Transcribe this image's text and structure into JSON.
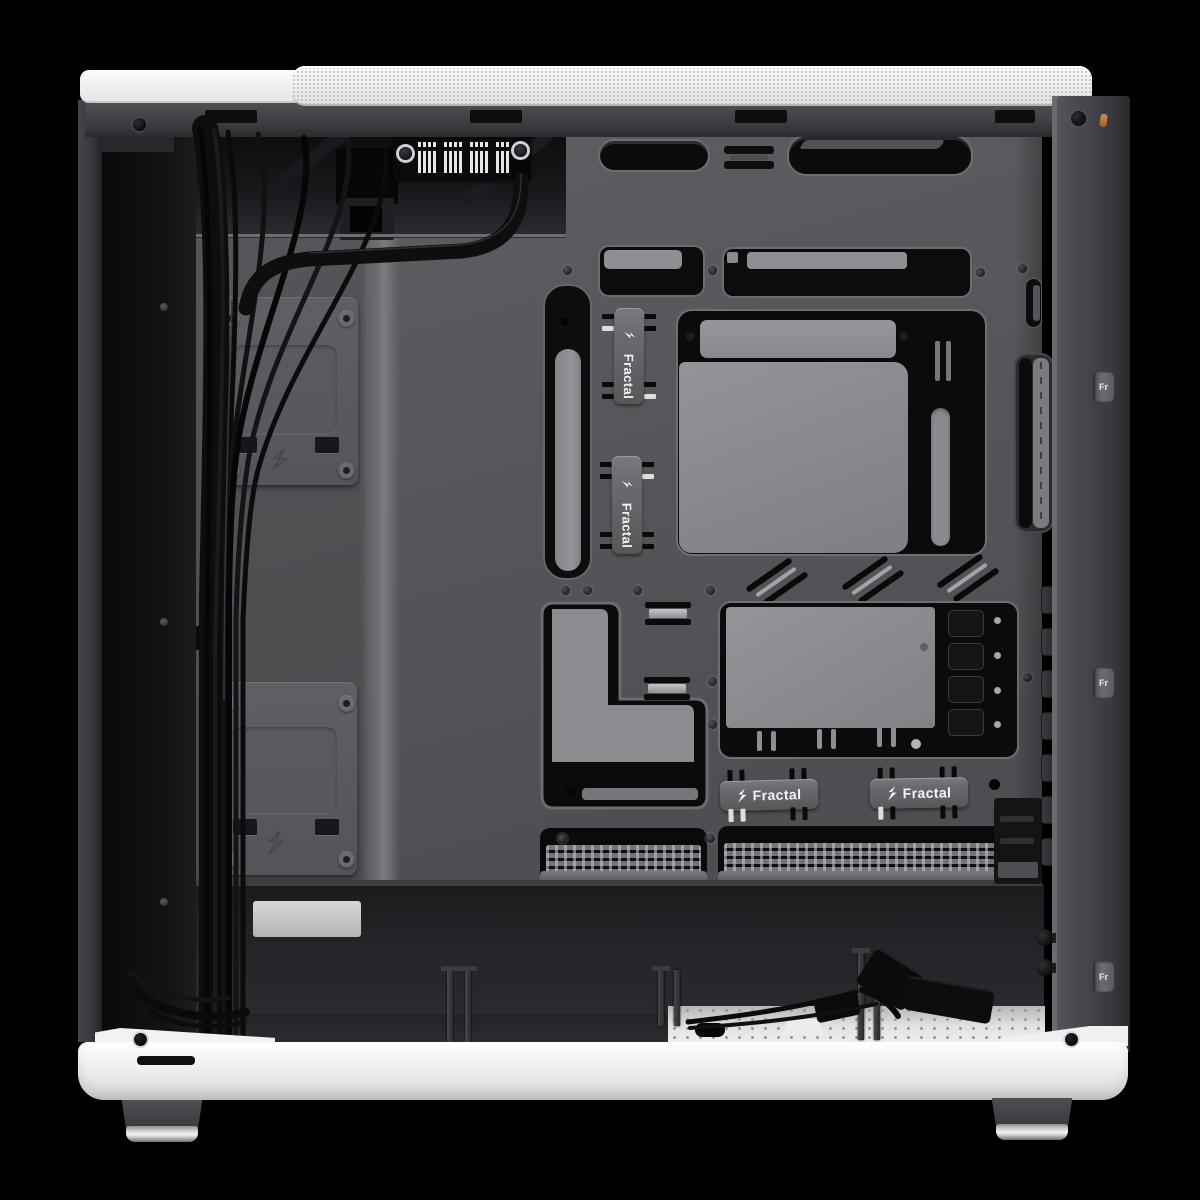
{
  "product": {
    "brand": "Fractal",
    "scene": "Open white PC case, cable-management side interior view",
    "straps": {
      "vertical": [
        {
          "label": "Fractal"
        },
        {
          "label": "Fractal"
        }
      ],
      "horizontal": [
        {
          "label": "Fractal"
        },
        {
          "label": "Fractal"
        }
      ],
      "edge": [
        {
          "label": "Fr"
        },
        {
          "label": "Fr"
        },
        {
          "label": "Fr"
        }
      ]
    }
  },
  "colors": {
    "background": "#000000",
    "tray_gray": "#58565b",
    "frame_gray": "#47454a",
    "panel_white": "#f2f2f3",
    "cutout_black": "#0c0c0e",
    "inner_plate_gray": "#8d8c91",
    "strap_gray": "#6b696e",
    "chrome_foot": "#d8d8da",
    "accent_pin_orange": "#b9763c"
  }
}
